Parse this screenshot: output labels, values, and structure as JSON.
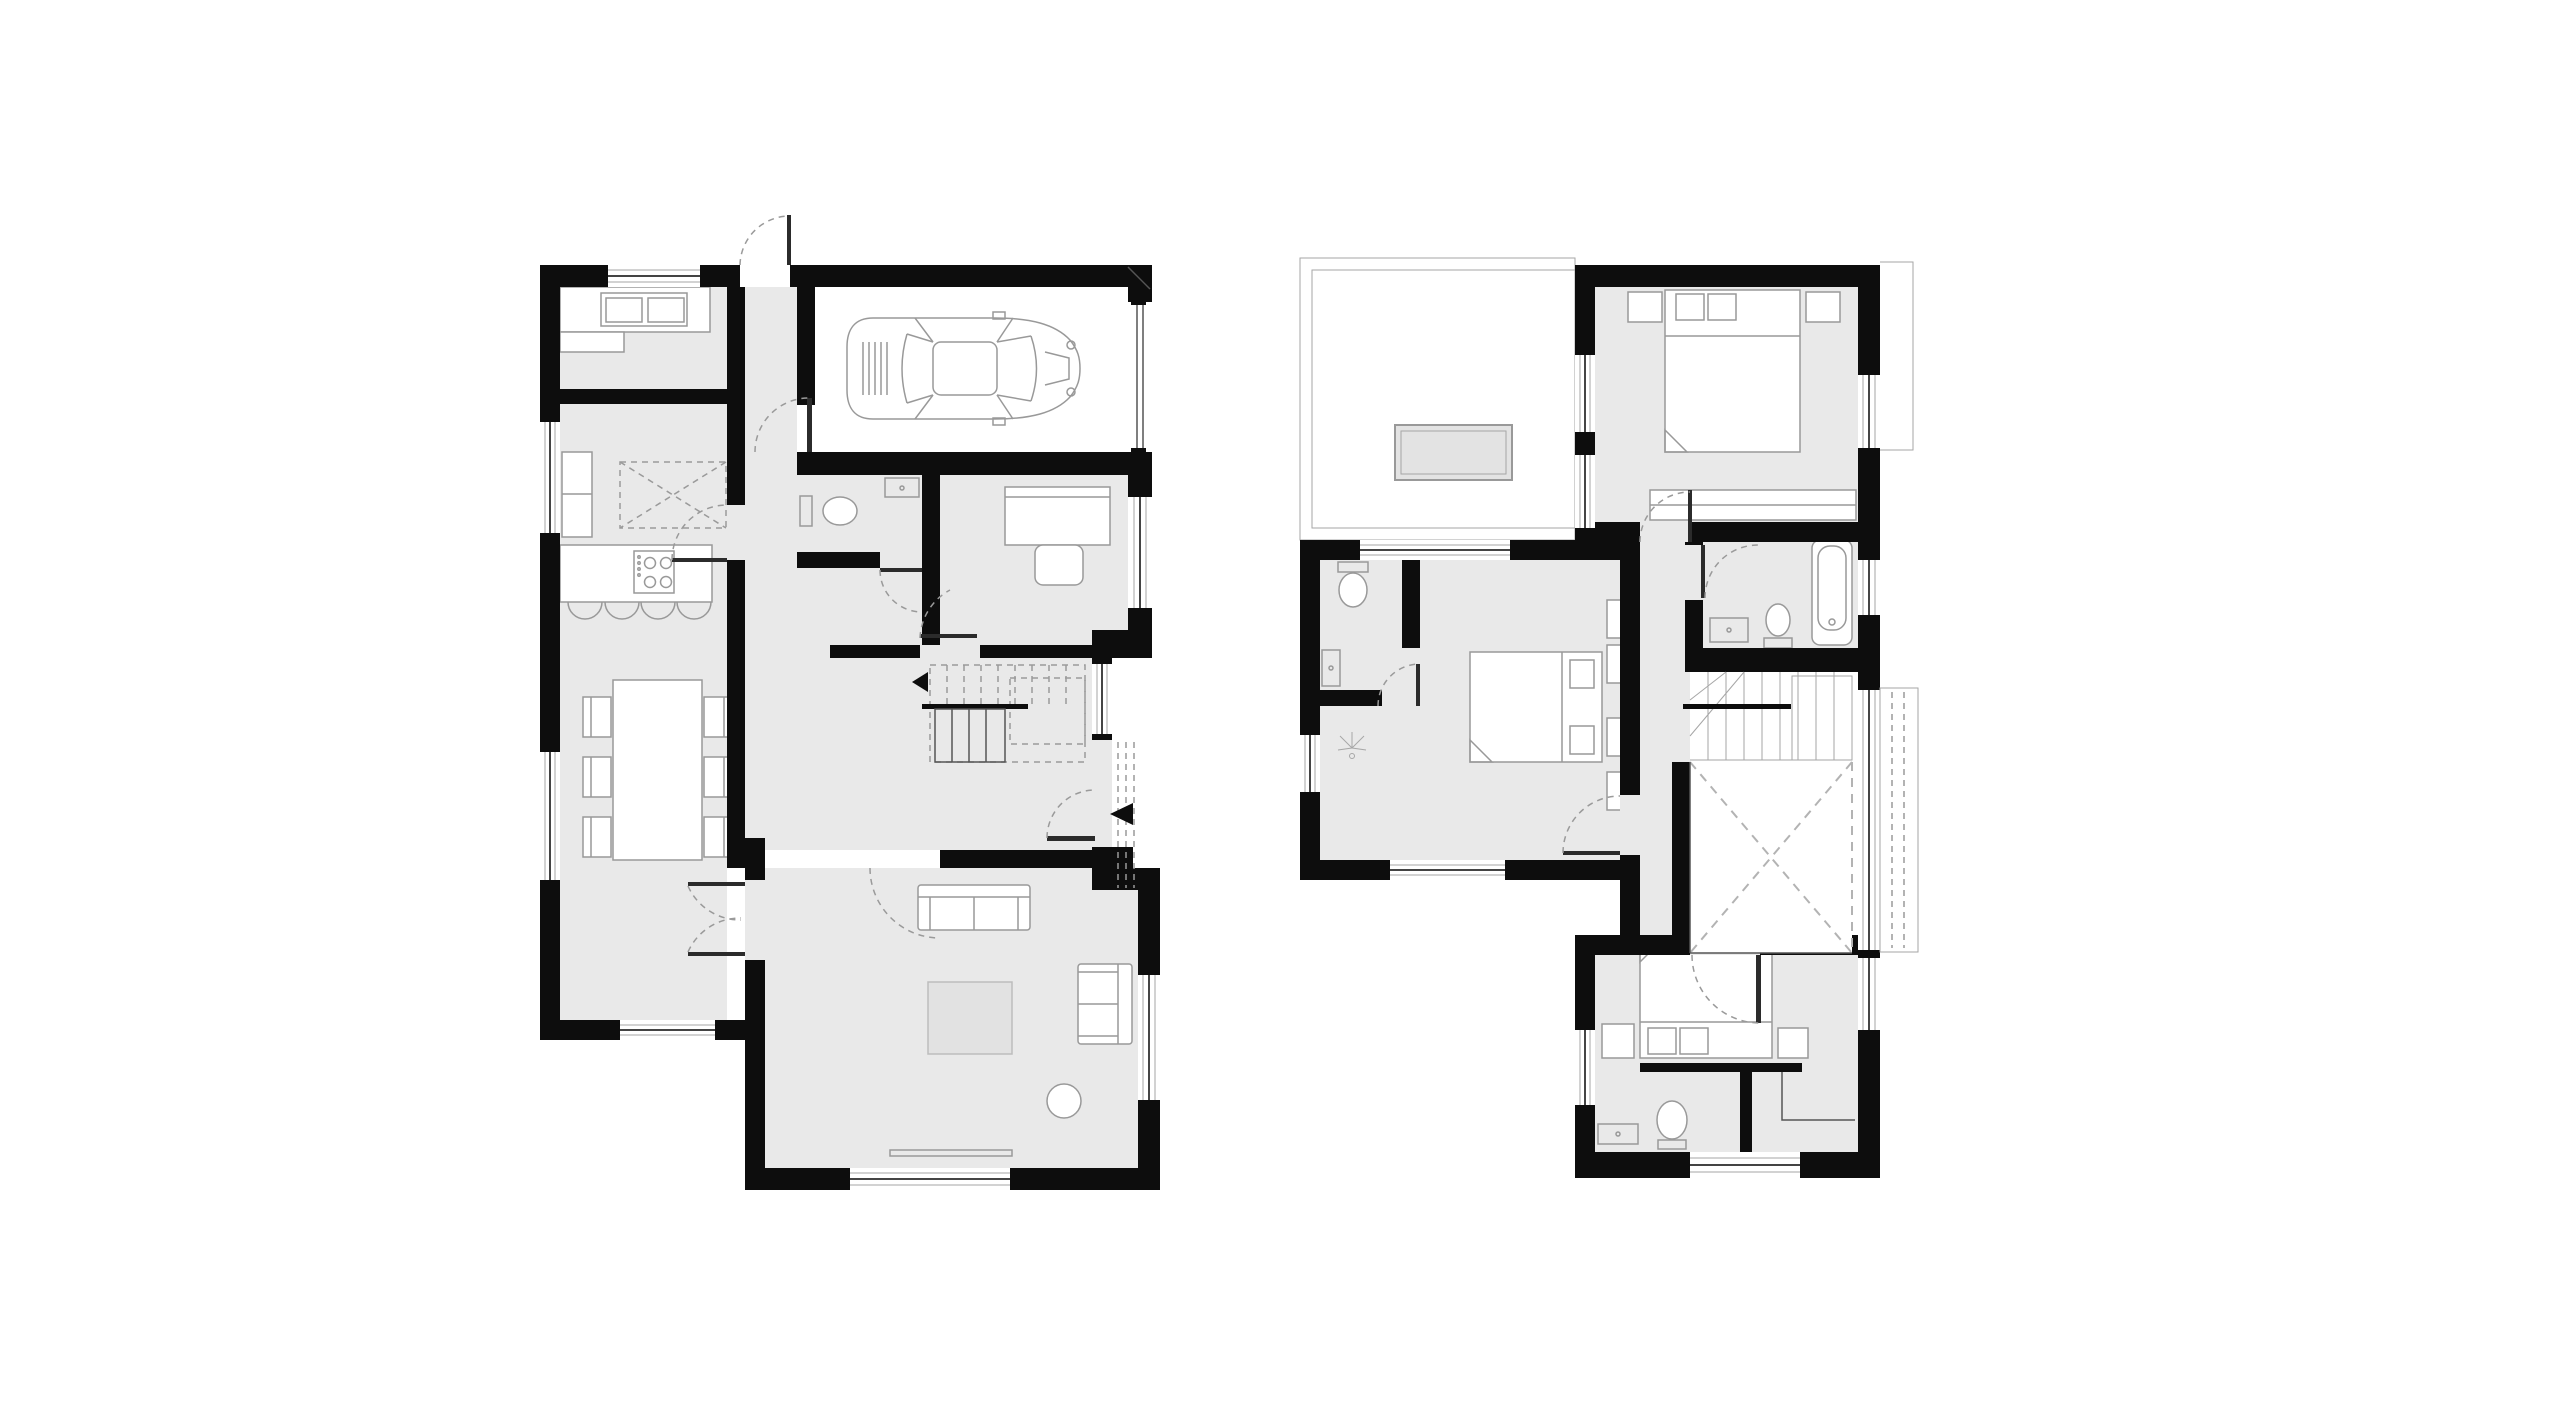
{
  "document": {
    "title": "Two-storey house floor plans",
    "sheet": {
      "width_px": 2560,
      "height_px": 1417,
      "background": "#ffffff"
    }
  },
  "colors": {
    "wall": "#0d0d0d",
    "room": "#e9e9e9",
    "white": "#ffffff",
    "line": "#999999",
    "line-dark": "#555555",
    "thin": "#a6a6a6",
    "dash": "#9a9a9a",
    "void-dash": "#b3b3b3",
    "leaf": "#2b2b2b",
    "glass": "#444444",
    "rug": "#e2e2e2",
    "rug-border": "#bdbdbd",
    "skylight": "#e3e3e3"
  },
  "floors": [
    {
      "id": "ground-floor",
      "position": "left",
      "rooms": [
        {
          "name": "utility-room",
          "fixtures": [
            "worktop",
            "double-sink"
          ]
        },
        {
          "name": "kitchen",
          "fixtures": [
            "tall-cabinet",
            "kitchen-island-dashed",
            "hob-counter",
            "cooktop-4-burners",
            "bar-stools-x4"
          ]
        },
        {
          "name": "dining-area",
          "fixtures": [
            "dining-table",
            "chairs-x6"
          ]
        },
        {
          "name": "garage",
          "fixtures": [
            "car",
            "garage-door"
          ]
        },
        {
          "name": "wc",
          "fixtures": [
            "toilet",
            "hand-basin"
          ]
        },
        {
          "name": "study",
          "fixtures": [
            "desk",
            "chair"
          ]
        },
        {
          "name": "hallway",
          "fixtures": [
            "entrance-door",
            "entrance-arrow",
            "porch-posts-dashed"
          ]
        },
        {
          "name": "staircase",
          "fixtures": [
            "lower-flight",
            "upper-flight-dashed",
            "direction-arrow"
          ]
        },
        {
          "name": "living-room",
          "fixtures": [
            "sofa",
            "sofa-2",
            "rug",
            "plant",
            "sideboard"
          ]
        }
      ]
    },
    {
      "id": "first-floor",
      "position": "right",
      "rooms": [
        {
          "name": "roof-terrace",
          "fixtures": [
            "parapet",
            "skylight"
          ]
        },
        {
          "name": "master-bedroom",
          "fixtures": [
            "double-bed",
            "nightstands-x2",
            "wardrobe"
          ]
        },
        {
          "name": "bathroom",
          "fixtures": [
            "bathtub",
            "toilet",
            "wash-basin"
          ]
        },
        {
          "name": "bedroom-2",
          "fixtures": [
            "double-bed",
            "nightstands-x2"
          ]
        },
        {
          "name": "wc-upper",
          "fixtures": [
            "toilet",
            "wash-basin",
            "shower-spray"
          ]
        },
        {
          "name": "landing",
          "fixtures": []
        },
        {
          "name": "staircase-void",
          "fixtures": [
            "stair-flight",
            "void-x-dashed",
            "balustrade",
            "juliet-balcony"
          ]
        },
        {
          "name": "bedroom-3",
          "fixtures": [
            "double-bed",
            "nightstands-x2",
            "ensuite-toilet",
            "ensuite-basin",
            "closet-rail"
          ]
        }
      ]
    }
  ]
}
